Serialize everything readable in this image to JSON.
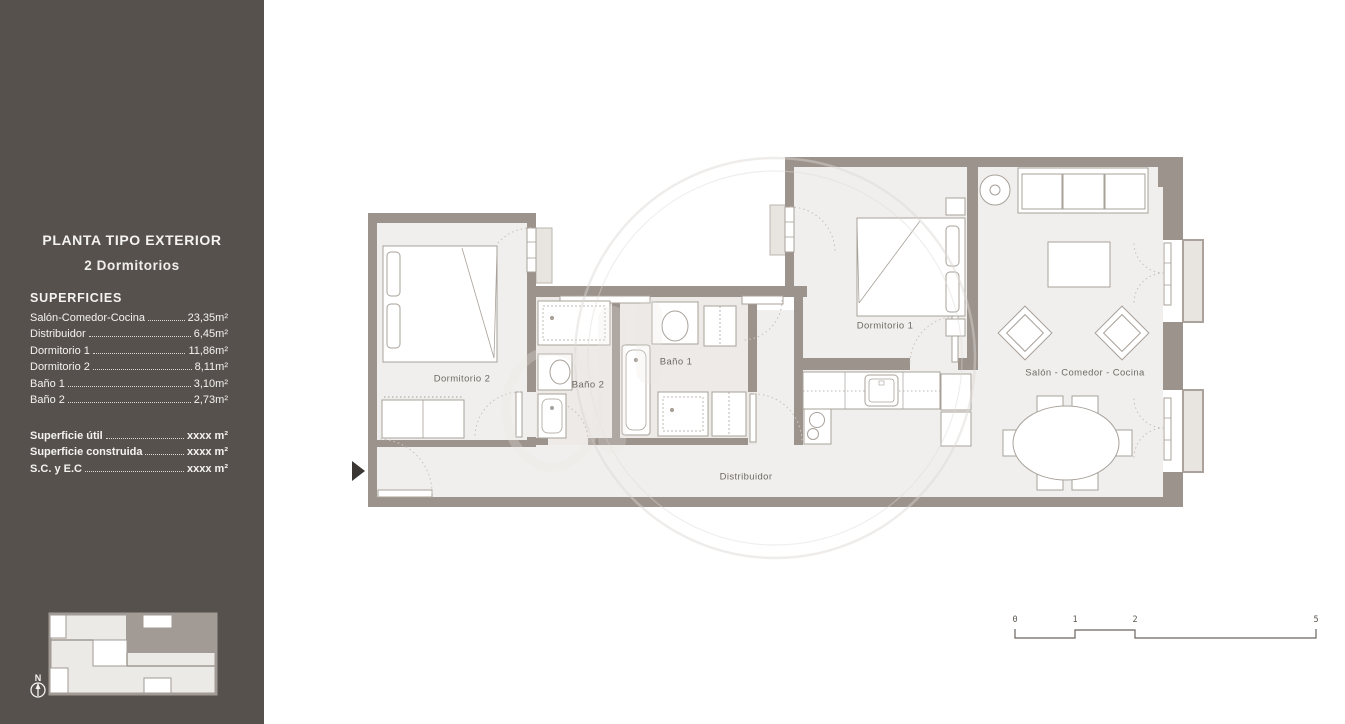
{
  "sidebar": {
    "title_line1": "PLANTA TIPO EXTERIOR",
    "title_line2": "2 Dormitorios",
    "section_heading": "SUPERFICIES",
    "areas": [
      {
        "label": "Salón-Comedor-Cocina",
        "value": "23,35m²"
      },
      {
        "label": "Distribuidor",
        "value": "6,45m²"
      },
      {
        "label": "Dormitorio 1",
        "value": "11,86m²"
      },
      {
        "label": "Dormitorio 2",
        "value": "8,11m²"
      },
      {
        "label": "Baño 1",
        "value": "3,10m²"
      },
      {
        "label": "Baño 2",
        "value": "2,73m²"
      }
    ],
    "totals": [
      {
        "label": "Superficie útil",
        "value": "xxxx m²"
      },
      {
        "label": "Superficie construida",
        "value": "xxxx m²"
      },
      {
        "label": "S.C. y E.C",
        "value": "xxxx m²"
      }
    ],
    "compass_label": "N"
  },
  "floor_plan": {
    "labels": {
      "dormitorio2": "Dormitorio 2",
      "bano2": "Baño 2",
      "bano1": "Baño 1",
      "dormitorio1": "Dormitorio 1",
      "salon": "Salón - Comedor - Cocina",
      "distribuidor": "Distribuidor"
    }
  },
  "scale_bar": {
    "ticks": [
      "0",
      "1",
      "2",
      "5"
    ]
  },
  "colors": {
    "sidebar_bg": "#56514d",
    "wall": "#9c938c",
    "floor": "#f1efed",
    "bath_floor": "#edeae7",
    "terrace": "#e8e5e1",
    "label_text": "#6f6a65"
  }
}
